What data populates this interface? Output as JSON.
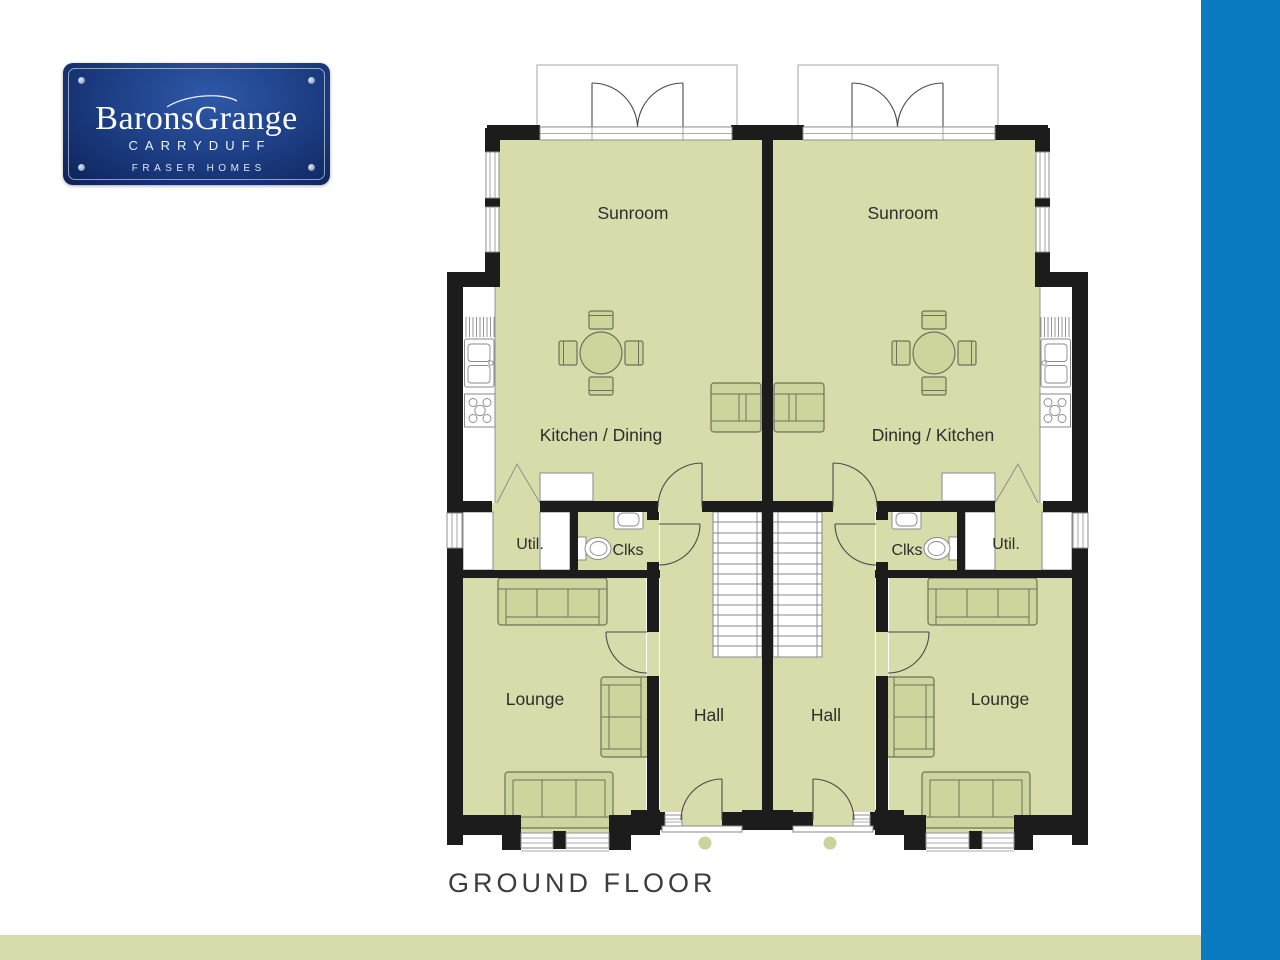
{
  "logo": {
    "estate_name": "BaronsGrange",
    "location": "CARRYDUFF",
    "developer": "FRASER HOMES"
  },
  "floor_title": "GROUND FLOOR",
  "units": {
    "left": {
      "sunroom": "Sunroom",
      "kitchen_dining": "Kitchen / Dining",
      "utility": "Util.",
      "cloakroom": "Clks",
      "lounge": "Lounge",
      "hall": "Hall"
    },
    "right": {
      "sunroom": "Sunroom",
      "kitchen_dining": "Dining / Kitchen",
      "utility": "Util.",
      "cloakroom": "Clks",
      "lounge": "Lounge",
      "hall": "Hall"
    }
  },
  "colors": {
    "accent_blue": "#0a7ac1",
    "floor_green": "#d8dcaa",
    "furniture_green": "#cdd49c",
    "wall_black": "#1c1c1c",
    "logo_navy_dark": "#0d2258",
    "logo_navy_light": "#2e59a8"
  }
}
